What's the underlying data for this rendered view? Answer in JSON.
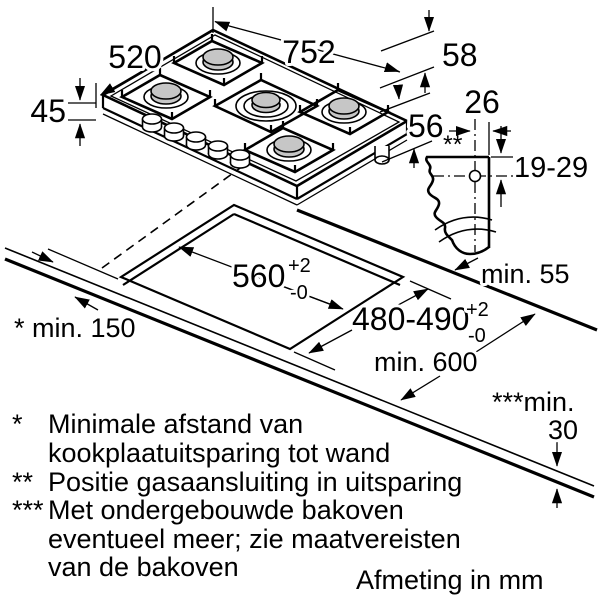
{
  "dims": {
    "width": "752",
    "depth": "520",
    "height": "45",
    "support_height": "58",
    "build_depth": "56"
  },
  "gas": {
    "offset": "26",
    "marker": "**",
    "range": "19-29"
  },
  "cutout": {
    "depth": "560",
    "depth_tol_up": "+2",
    "depth_tol_down": "-0",
    "width": "480-490",
    "width_tol_up": "+2",
    "width_tol_down": "-0"
  },
  "clearances": {
    "rear": "min. 55",
    "side": "* min. 150",
    "front": "min. 600",
    "oven_label": "***min.",
    "oven_value": "30"
  },
  "footnotes": [
    {
      "marker": "*",
      "lines": [
        "Minimale afstand van",
        "kookplaatuitsparing tot wand"
      ]
    },
    {
      "marker": "**",
      "lines": [
        "Positie gasaansluiting in uitsparing"
      ]
    },
    {
      "marker": "***",
      "lines": [
        "Met ondergebouwde bakoven",
        "eventueel meer; zie maatvereisten",
        "van de bakoven"
      ]
    }
  ],
  "units_note": "Afmeting in mm",
  "colors": {
    "line": "#000000",
    "burner_fill": "#c6c6c6",
    "background": "#ffffff"
  }
}
